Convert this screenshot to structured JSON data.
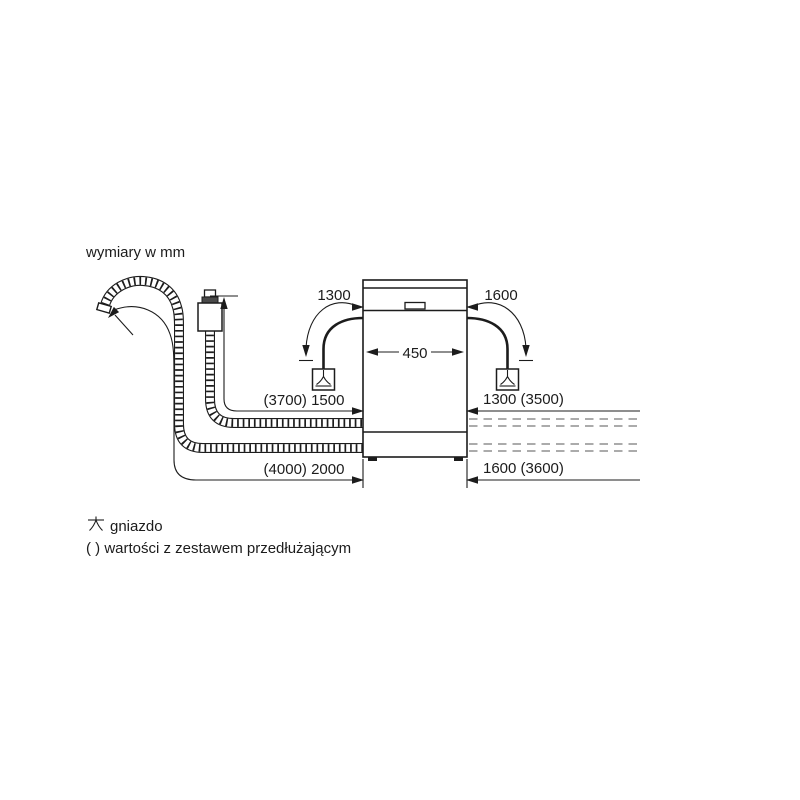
{
  "page": {
    "title": "wymiary w mm"
  },
  "colors": {
    "line": "#1c1c1c",
    "hose_dashed": "#8f8f8f",
    "background": "#ffffff"
  },
  "diagram": {
    "appliance_width": "450",
    "socket_left_distance": "1300",
    "socket_right_distance": "1600",
    "supply_hose_left": "(3700) 1500",
    "drain_hose_left": "(4000) 2000",
    "supply_hose_right": "1300 (3500)",
    "drain_hose_right": "1600 (3600)"
  },
  "legend": {
    "socket_label": "gniazdo",
    "parentheses_label": "( ) wartości z zestawem przedłużającym"
  }
}
